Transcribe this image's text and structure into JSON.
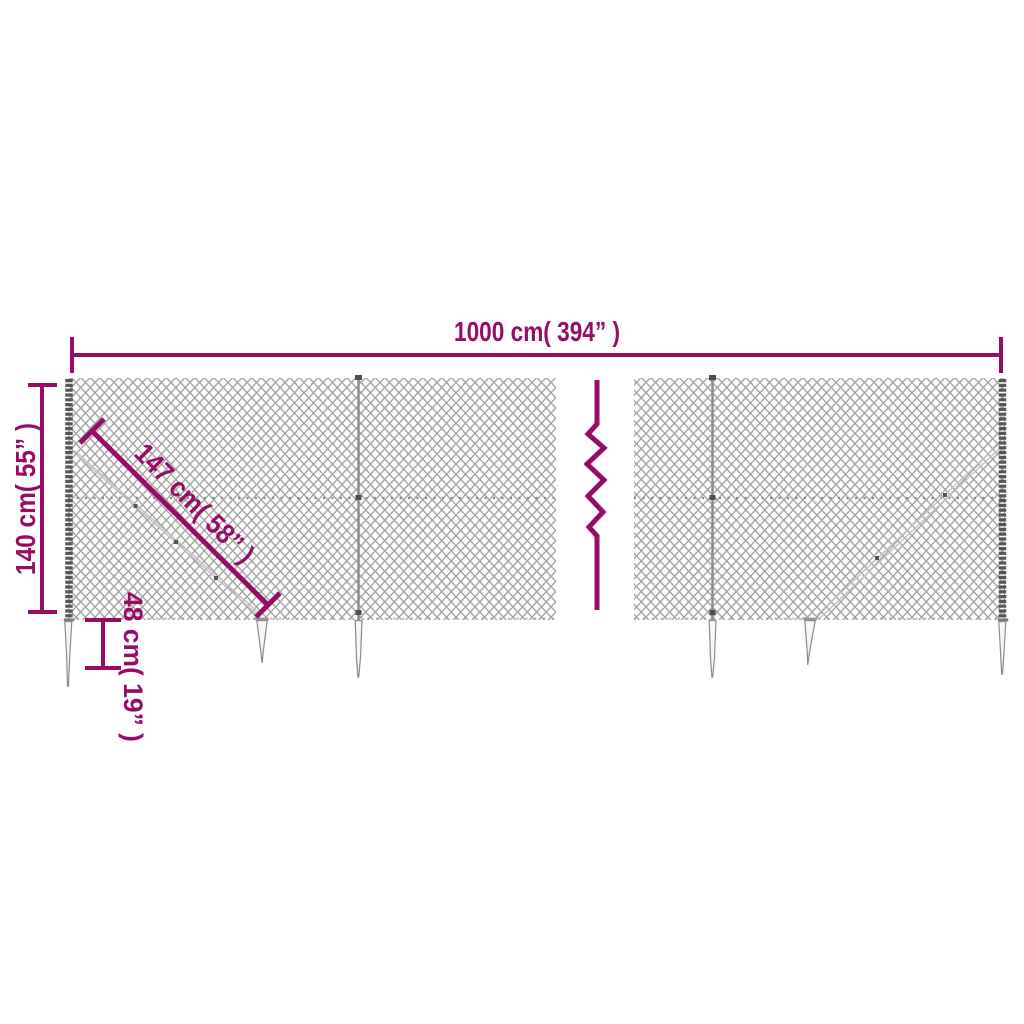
{
  "diagram": {
    "dimensions": {
      "total_width": {
        "label": "1000 cm( 394” )",
        "value_cm": 1000,
        "value_inch": 394
      },
      "height": {
        "label": "140 cm( 55” )",
        "value_cm": 140,
        "value_inch": 55
      },
      "diagonal_brace": {
        "label": "147 cm( 58” )",
        "value_cm": 147,
        "value_inch": 58
      },
      "spike_anchor": {
        "label": "48 cm( 19” )",
        "value_cm": 48,
        "value_inch": 19
      }
    },
    "colors": {
      "dimension_accent": "#970d66",
      "mesh_gray": "#a3a3a3",
      "post_dark": "#565656",
      "background": "#ffffff"
    }
  }
}
